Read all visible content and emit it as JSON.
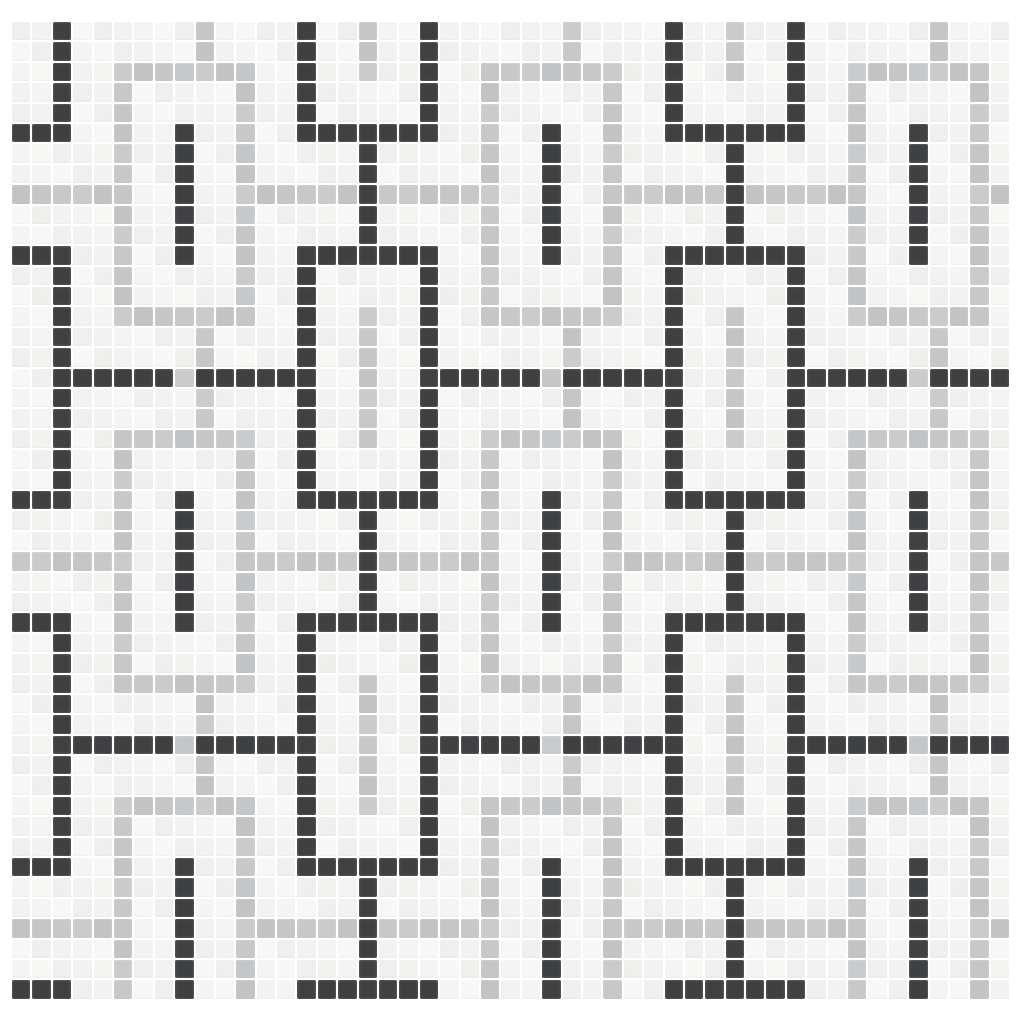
{
  "image": {
    "width": 1024,
    "height": 1024,
    "background": "#ffffff",
    "description": "Mosaic tile sheet: interlocking rectangular chain-link pattern of dark charcoal and light gray rings on off-white square tiles"
  },
  "mosaic": {
    "columns": 49,
    "rows": 48,
    "geometry": {
      "offset_left_px": 12,
      "offset_top_px": 22,
      "tile_px": 18.4,
      "grout_px": 2
    },
    "palette": {
      "white_tile": "#f3f3f1",
      "gray_tile": "#c6c7c9",
      "dark_tile": "#3f4042",
      "grout": "#ffffff"
    },
    "legend": {
      ".": "white_tile",
      "L": "gray_tile",
      "D": "dark_tile"
    },
    "period": 18,
    "period_rows": [
      "..D......L....D..L",
      "..D......L....D..L",
      "..D..LLLLLLL..D..L",
      "..D..L.....L..D...",
      "..D..L.....L..D...",
      "DDD..L..D..L..DDDD",
      ".....L..D..L.....D",
      ".....L..D..L.....D",
      "LLLLLL..D..LLLLLLD",
      ".....L..D..L.....D",
      ".....L..D..L.....D",
      "DDD..L..D..L..DDDD",
      "..D..L.....L..D...",
      "..D..L.....L..D...",
      "..D..LLLLLLL..D..L",
      "..D......L....D..L",
      "..D......L....D..L",
      "..DDDDDDLDDDDDD..L"
    ]
  }
}
